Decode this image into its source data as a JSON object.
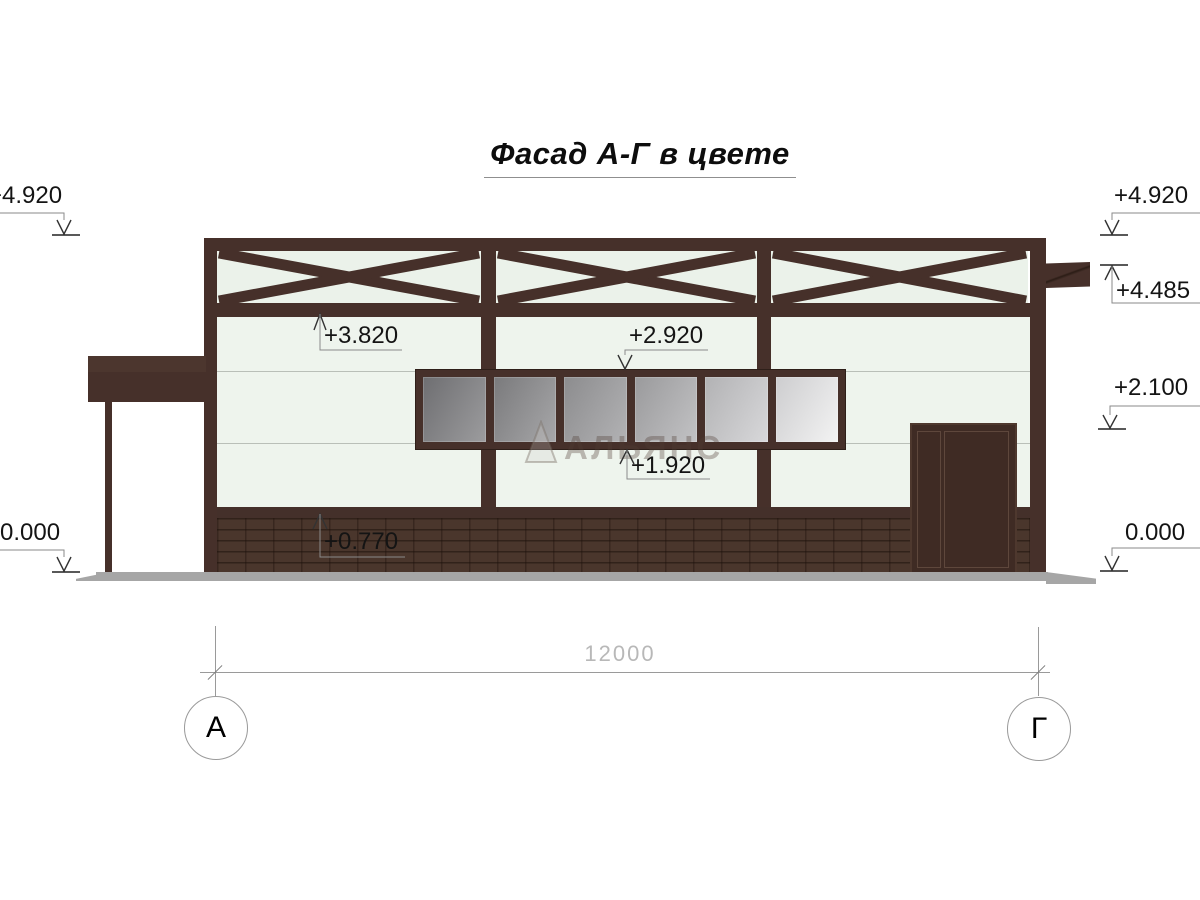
{
  "title": "Фасад А-Г в цвете",
  "watermark": {
    "brand": "АЛЬЯНС"
  },
  "markers": {
    "left_top": "+4.920",
    "left_bottom": "0.000",
    "right_roof": "+4.920",
    "right_truss": "+4.485",
    "right_door": "+2.100",
    "right_ground": "0.000",
    "int_girt": "+3.820",
    "int_window_top": "+2.920",
    "int_window_bottom": "+1.920",
    "int_brick_top": "+0.770"
  },
  "dimension": {
    "length": "12000"
  },
  "axes": {
    "left": "А",
    "right": "Г"
  },
  "colors": {
    "structure_brown": "#46302a",
    "door_brown": "#3f2b24",
    "brick": "#4a362c",
    "wall": "#eef4ed",
    "ground_gray": "#a6a6a6",
    "dim_text": "#b8b8b8"
  }
}
